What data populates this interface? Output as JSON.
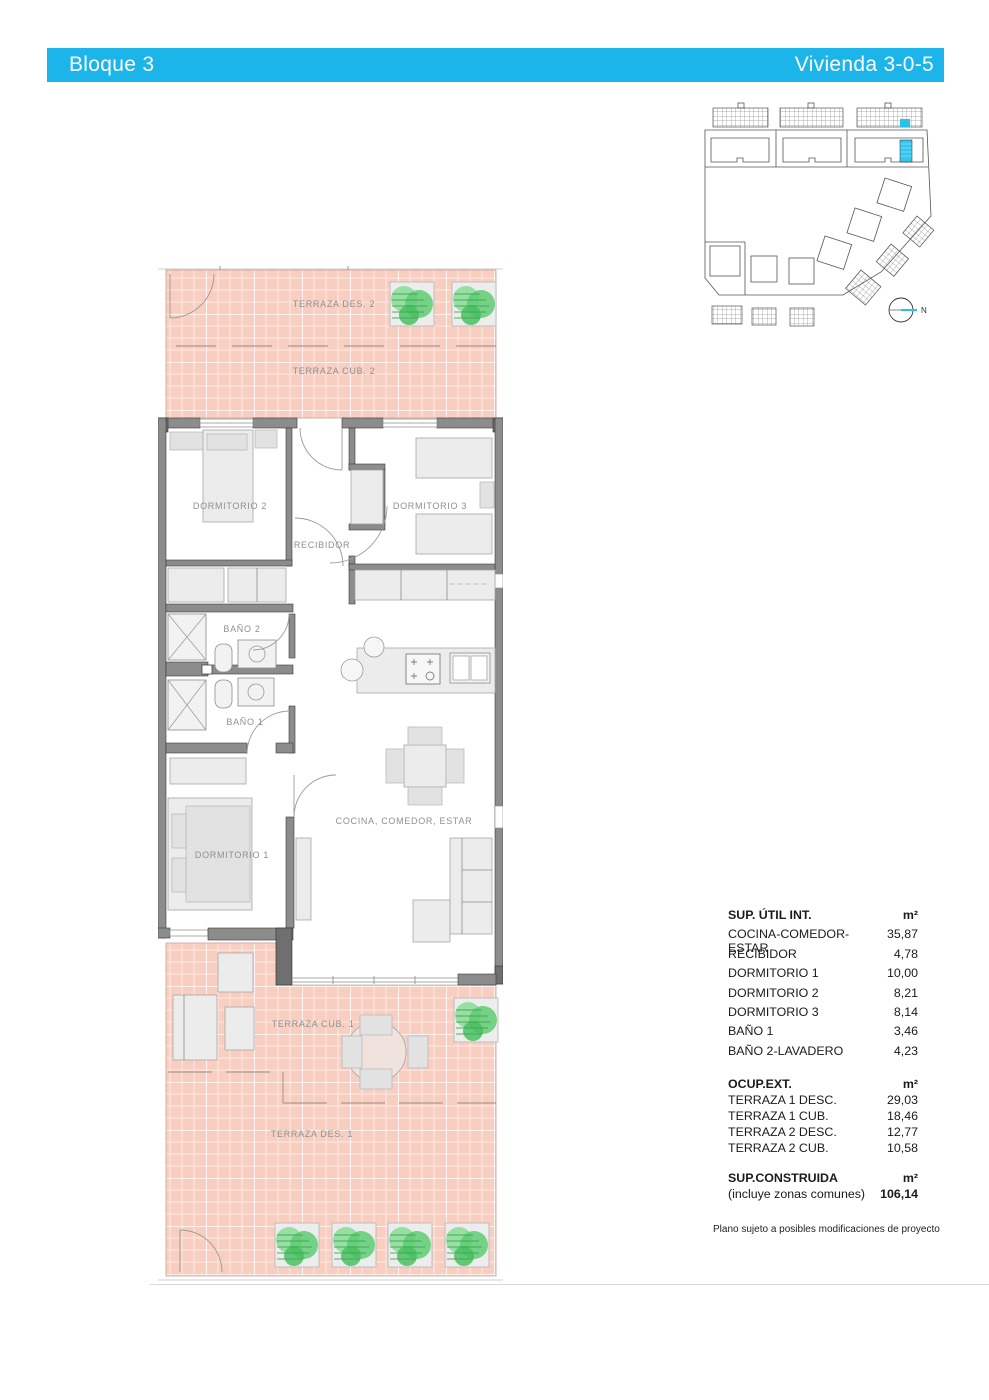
{
  "header": {
    "left_title": "Bloque 3",
    "right_title": "Vivienda 3-0-5",
    "bar_color": "#1cb5ea",
    "text_color": "#ffffff"
  },
  "floor_plan": {
    "labels": {
      "terraza_des_2": "TERRAZA DES. 2",
      "terraza_cub_2": "TERRAZA CUB. 2",
      "dormitorio_2": "DORMITORIO 2",
      "dormitorio_3": "DORMITORIO 3",
      "recibidor": "RECIBIDOR",
      "bano_2": "BAÑO 2",
      "bano_1": "BAÑO 1",
      "dormitorio_1": "DORMITORIO 1",
      "cocina_comedor_estar": "COCINA, COMEDOR, ESTAR",
      "terraza_cub_1": "TERRAZA CUB. 1",
      "terraza_des_1": "TERRAZA DES. 1"
    },
    "colors": {
      "terrace_fill": "#f8cec0",
      "wall_fill": "#8c8c8c",
      "plant_green": "#5ecb72"
    }
  },
  "site_plan": {
    "north_label": "N",
    "highlight_color": "#29c3ea"
  },
  "areas_table": {
    "interior": {
      "title": "SUP. ÚTIL INT.",
      "unit": "m²",
      "rows": [
        {
          "label": "COCINA-COMEDOR-ESTAR",
          "value": "35,87"
        },
        {
          "label": "RECIBIDOR",
          "value": "4,78"
        },
        {
          "label": "DORMITORIO 1",
          "value": "10,00"
        },
        {
          "label": "DORMITORIO 2",
          "value": "8,21"
        },
        {
          "label": "DORMITORIO 3",
          "value": "8,14"
        },
        {
          "label": "BAÑO 1",
          "value": "3,46"
        },
        {
          "label": "BAÑO 2-LAVADERO",
          "value": "4,23"
        }
      ]
    },
    "exterior": {
      "title": "OCUP.EXT.",
      "unit": "m²",
      "rows": [
        {
          "label": "TERRAZA 1 DESC.",
          "value": "29,03"
        },
        {
          "label": "TERRAZA 1 CUB.",
          "value": "18,46"
        },
        {
          "label": "TERRAZA 2 DESC.",
          "value": "12,77"
        },
        {
          "label": "TERRAZA 2 CUB.",
          "value": "10,58"
        }
      ]
    },
    "built": {
      "title": "SUP.CONSTRUIDA",
      "unit": "m²",
      "subtitle": "(incluye zonas comunes)",
      "value": "106,14"
    }
  },
  "footnote": "Plano sujeto a posibles modificaciones de proyecto"
}
